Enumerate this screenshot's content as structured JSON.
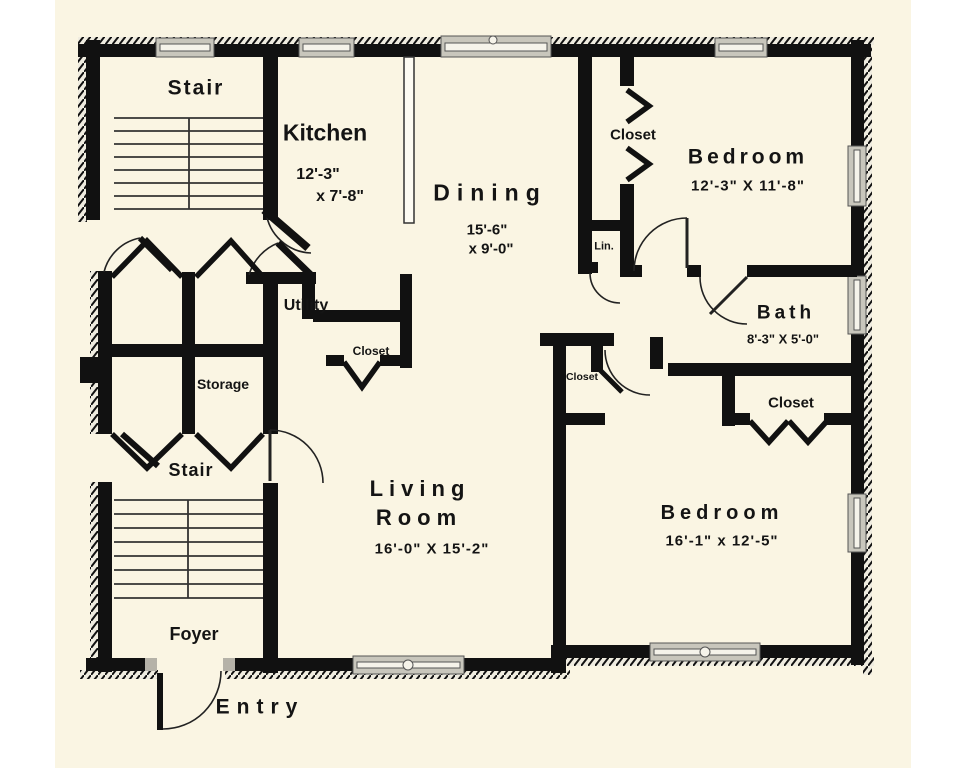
{
  "plan": {
    "type": "residential floor plan"
  },
  "rooms": {
    "stair_upper": {
      "name": "Stair"
    },
    "kitchen": {
      "name": "Kitchen",
      "dim_line1": "12'-3\"",
      "dim_line2": "x 7'-8\""
    },
    "dining": {
      "name": "Dining",
      "dim_line1": "15'-6\"",
      "dim_line2": "x 9'-0\""
    },
    "closet_top": {
      "name": "Closet"
    },
    "bedroom_top": {
      "name": "Bedroom",
      "dims": "12'-3\" X 11'-8\""
    },
    "linen": {
      "name": "Lin."
    },
    "bath": {
      "name": "Bath",
      "dims": "8'-3\" X 5'-0\""
    },
    "utility": {
      "name": "Utility"
    },
    "closet_utility": {
      "name": "Closet"
    },
    "storage": {
      "name": "Storage"
    },
    "stair_lower": {
      "name": "Stair"
    },
    "closet_mid": {
      "name": "Closet"
    },
    "closet_bedroom2": {
      "name": "Closet"
    },
    "living_room": {
      "name_line1": "Living",
      "name_line2": "Room",
      "dims": "16'-0\" X 15'-2\""
    },
    "bedroom_main": {
      "name": "Bedroom",
      "dims": "16'-1\" x 12'-5\""
    },
    "foyer": {
      "name": "Foyer"
    },
    "entry": {
      "name": "Entry"
    }
  },
  "colors": {
    "page_background": "#ffffff",
    "plan_background": "#faf5e3",
    "wall": "#111111",
    "window": "#c8c6bc"
  }
}
